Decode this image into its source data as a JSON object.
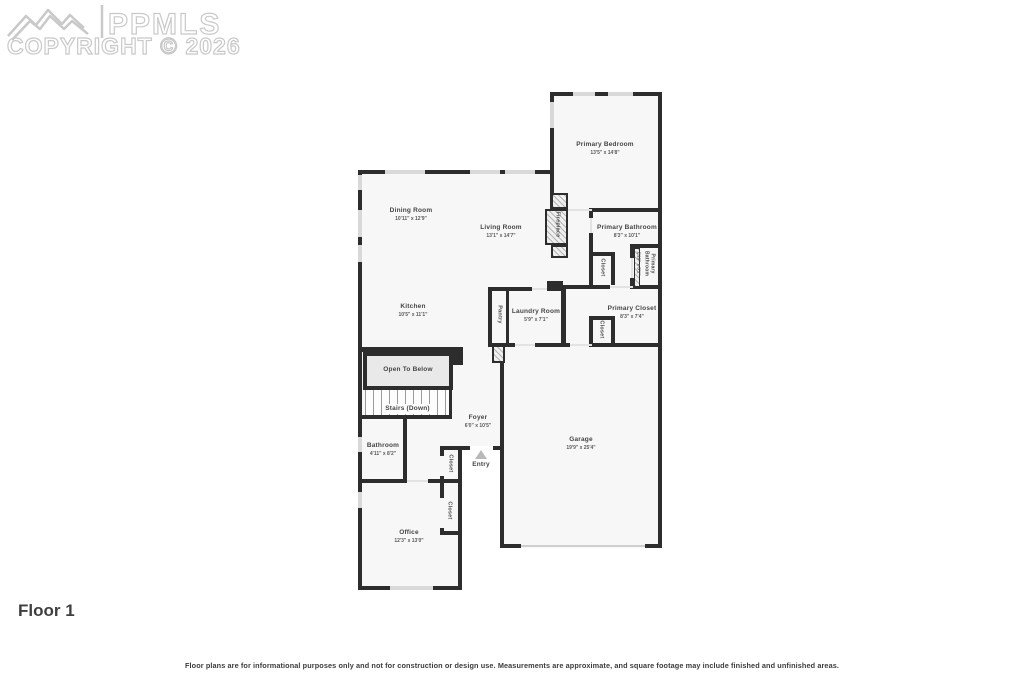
{
  "watermark": {
    "brand": "PPMLS",
    "copyright": "COPYRIGHT © 2026"
  },
  "floor_label": "Floor 1",
  "disclaimer": "Floor plans are for informational purposes only and not for construction or design use. Measurements are approximate, and square footage may include finished and unfinished areas.",
  "rooms": {
    "primary_bedroom": {
      "name": "Primary Bedroom",
      "dims": "13'5\" x 14'8\""
    },
    "dining_room": {
      "name": "Dining Room",
      "dims": "10'11\" x 12'9\""
    },
    "living_room": {
      "name": "Living Room",
      "dims": "13'1\" x 14'7\""
    },
    "kitchen": {
      "name": "Kitchen",
      "dims": "10'5\" x 11'1\""
    },
    "primary_bathroom": {
      "name": "Primary Bathroom",
      "dims": "8'3\" x 10'1\""
    },
    "primary_bathroom_wc": {
      "name": "Primary Bathroom",
      "dims": "2'10\" x 5'1\""
    },
    "primary_closet": {
      "name": "Primary Closet",
      "dims": "8'3\" x 7'4\""
    },
    "laundry_room": {
      "name": "Laundry Room",
      "dims": "5'9\" x 7'1\""
    },
    "pantry": {
      "name": "Pantry"
    },
    "fireplace": {
      "name": "Fireplace"
    },
    "open_to_below": {
      "name": "Open To Below"
    },
    "stairs": {
      "name": "Stairs (Down)"
    },
    "foyer": {
      "name": "Foyer",
      "dims": "6'0\" x 10'5\""
    },
    "bathroom": {
      "name": "Bathroom",
      "dims": "4'11\" x 8'2\""
    },
    "entry": {
      "name": "Entry"
    },
    "office": {
      "name": "Office",
      "dims": "12'3\" x 13'0\""
    },
    "garage": {
      "name": "Garage",
      "dims": "19'9\" x 25'4\""
    },
    "closet": {
      "name": "Closet"
    }
  },
  "colors": {
    "wall": "#2d2d2d",
    "window": "#d9d9d9",
    "floor": "#f7f7f7",
    "watermark": "#c9c9c9"
  }
}
